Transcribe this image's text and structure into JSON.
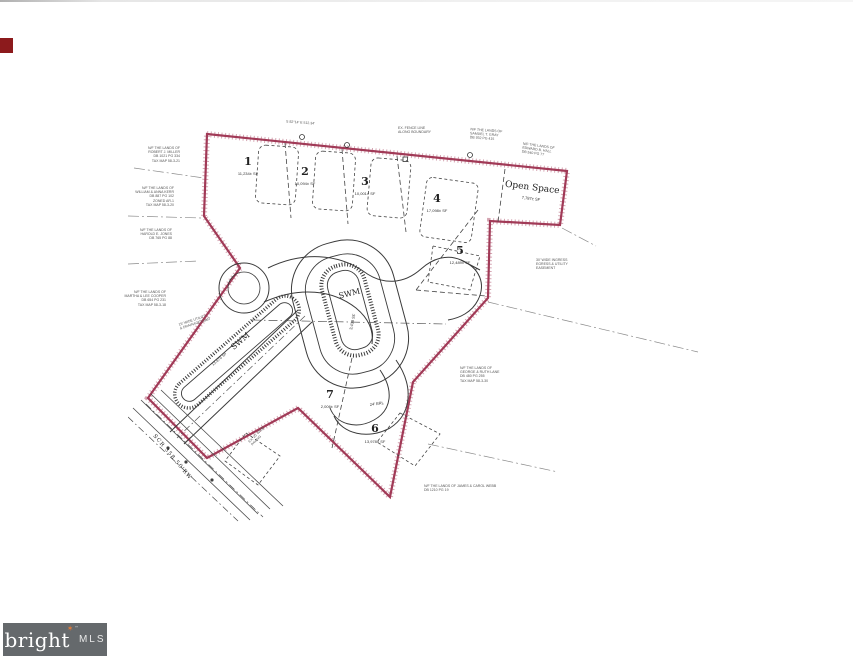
{
  "page": {
    "kind": "MLS listing photo — subdivision plat map"
  },
  "logo": {
    "brand": "bright",
    "star": "✶",
    "tm": "™",
    "suffix": "MLS"
  },
  "map": {
    "boundary_color": "#a13a57",
    "line_color": "#3a3a3a",
    "lots": [
      {
        "num": "1",
        "sf": "11,234± SF"
      },
      {
        "num": "2",
        "sf": "10,094± SF"
      },
      {
        "num": "3",
        "sf": "10,001± SF"
      },
      {
        "num": "4",
        "sf": "17,098± SF"
      },
      {
        "num": "5",
        "sf": "12,489± SF"
      },
      {
        "num": "6",
        "sf": "13,978± SF"
      },
      {
        "num": "7",
        "sf": "2,006± SF"
      }
    ],
    "open_space": {
      "label": "Open Space",
      "sf": "7,787± SF"
    },
    "swm_center": {
      "label": "SWM",
      "sf": "3,438 SF"
    },
    "swm_strip": {
      "label": "SWM",
      "sf": "13,879 SF"
    },
    "road_label": "SCR 358 50'RW",
    "brl_label": "24' BRL"
  },
  "annotations": {
    "t1": "N/F THE LANDS OF\nROBERT J. MILLER\nDB 1021 PG 334\nTAX MAP 58-3-21",
    "t2": "N/F THE LANDS OF\nWILLIAM & ANNA KERR\nDB 887 PG 102\nZONED AR-1\nTAX MAP 58-3-20",
    "t3": "N/F THE LANDS OF\nHAROLD E. JONES\nDB 765 PG 88",
    "t4": "N/F THE LANDS OF\nMARTHA & LEE COOPER\nDB 654 PG 231\nTAX MAP 58-3-18",
    "t5": "15' WIDE UTILITY\n& DRAINAGE ESMT",
    "t6": "EX. FENCE LINE\nALONG BOUNDARY",
    "t7": "N/F THE LANDS OF\nSAMUEL T. GRAY\nDB 932 PG 415",
    "t8": "N/F THE LANDS OF\nEDWARD B. HALL\nDB 540 PG 77",
    "t9": "30' WIDE INGRESS\nEGRESS & UTILITY\nEASEMENT",
    "t10": "N/F THE LANDS OF\nGEORGE & RUTH LANE\nDB 480 PG 255\nTAX MAP 58-3-30",
    "t11": "N/F THE LANDS OF JAMES & CAROL WEBB\nDB 1210 PG 19",
    "t12": "EX. 20' WIDE\nPAVING",
    "t13": "S 82°14' E  512.34'"
  }
}
